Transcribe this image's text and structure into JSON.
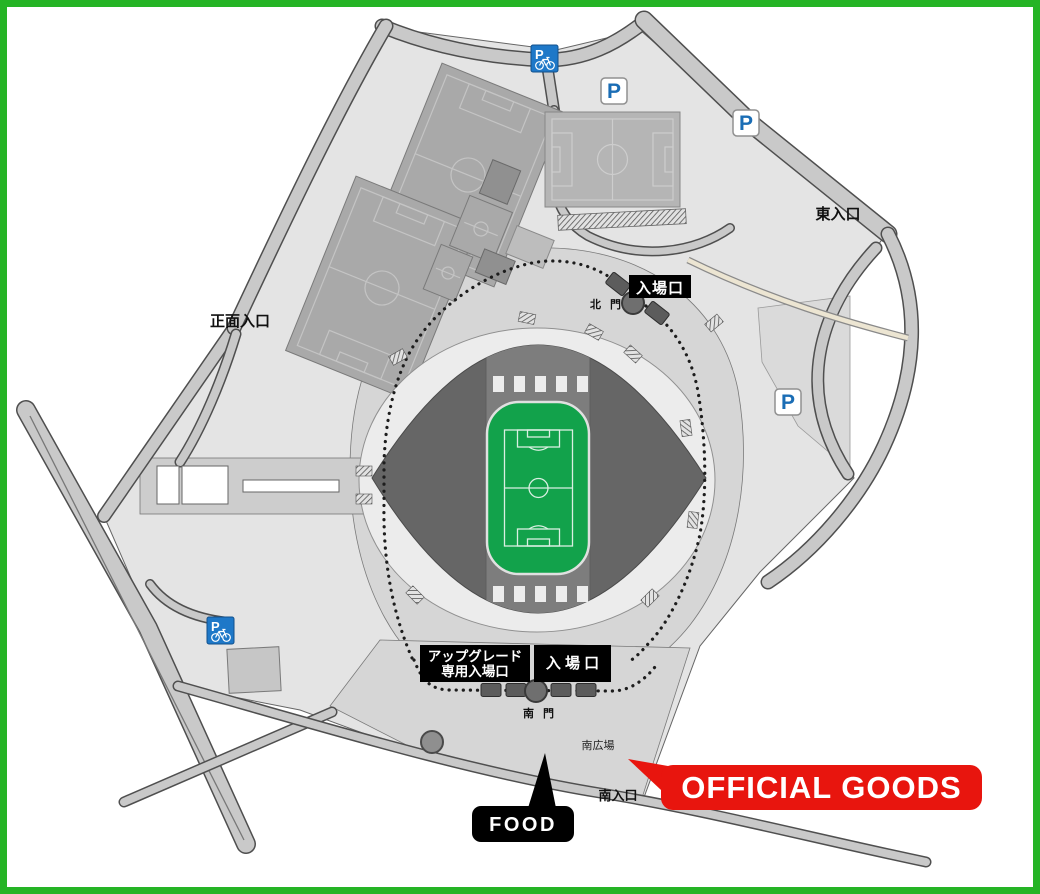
{
  "colors": {
    "border": "#25b425",
    "accent_red": "#e8150e",
    "parking_blue": "#1a6db5",
    "bicycle_sign_blue": "#1e78c8",
    "pitch_green": "#12a24b"
  },
  "labels": {
    "east_entrance": "東入口",
    "main_entrance": "正面入口",
    "north_admission": "入場口",
    "north_gate": "北 門",
    "upgrade_entrance_line1": "アップグレード",
    "upgrade_entrance_line2": "専用入場口",
    "south_admission": "入 場 口",
    "south_gate": "南 門",
    "south_plaza": "南広場",
    "south_entrance": "南入口"
  },
  "callouts": {
    "official_goods": "OFFICIAL GOODS",
    "food": "FOOD"
  },
  "icons": {
    "parking_label": "P",
    "bicycle_parking_label": "P"
  }
}
